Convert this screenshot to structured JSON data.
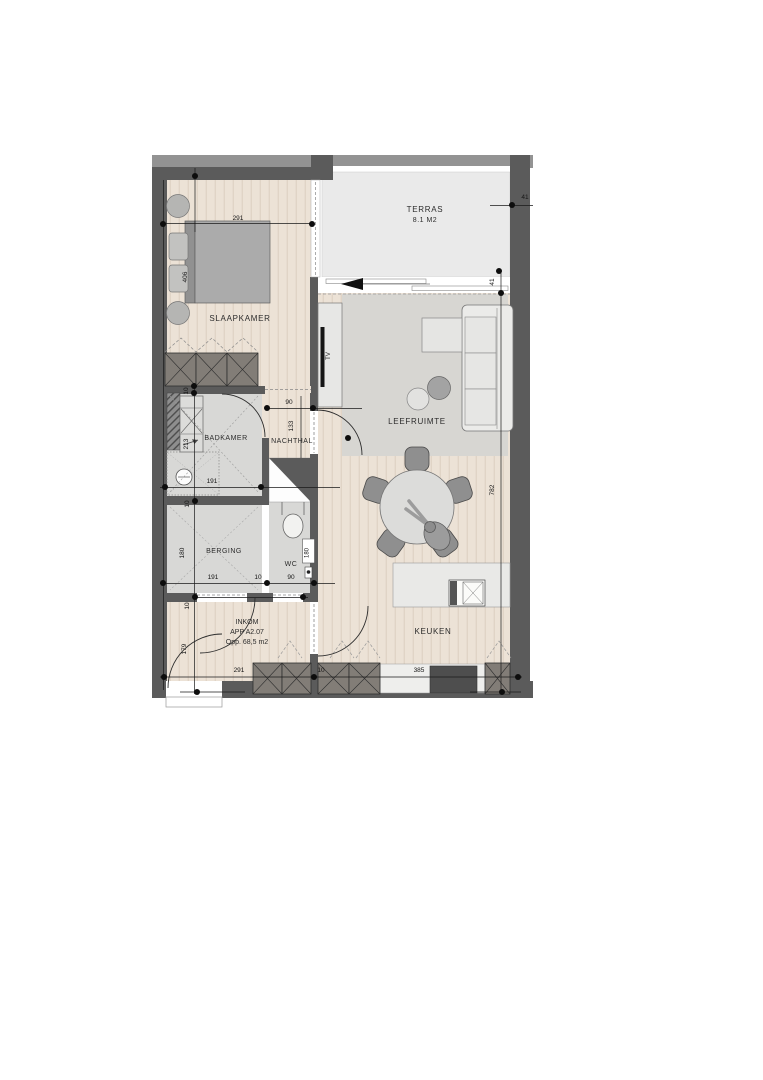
{
  "apartment": {
    "room_label": "INKOM",
    "code": "APP A2.07",
    "area": "Opp. 68,5 m2"
  },
  "rooms": {
    "slaapkamer": "SLAAPKAMER",
    "terras": "TERRAS",
    "terras_area": "8.1 M2",
    "leefruimte": "LEEFRUIMTE",
    "badkamer": "BADKAMER",
    "nachthal": "NACHTHAL",
    "berging": "BERGING",
    "wc": "WC",
    "keuken": "KEUKEN"
  },
  "furniture": {
    "tv_label": "TV"
  },
  "dimensions": {
    "slaapkamer_width": "291",
    "slaapkamer_depth": "406",
    "terras_wall_top": "41",
    "terras_wall_side": "41",
    "nachthal_door": "90",
    "nachthal_width": "133",
    "wall_thickness_badkamer": "10",
    "badkamer_depth": "213",
    "badkamer_width": "191",
    "wall_thickness_berging": "10",
    "berging_depth": "180",
    "berging_width": "191",
    "wall_thickness_wc": "10",
    "wc_door": "90",
    "wc_depth": "180",
    "wall_thickness_inkom": "10",
    "inkom_depth": "179",
    "inkom_width": "291",
    "wall_thickness_keuken": "10",
    "keuken_width": "385",
    "leefruimte_depth": "782"
  },
  "colors": {
    "wall": "#5b5b5b",
    "wall_outer": "#939393",
    "wood_floor": "#ece2d6",
    "tile_floor": "#d8d8d6",
    "terrace_floor": "#eaeaea",
    "rug": "#d7d6d2",
    "cabinet": "#827d77",
    "dimension_dot": "#0d0d0d"
  }
}
